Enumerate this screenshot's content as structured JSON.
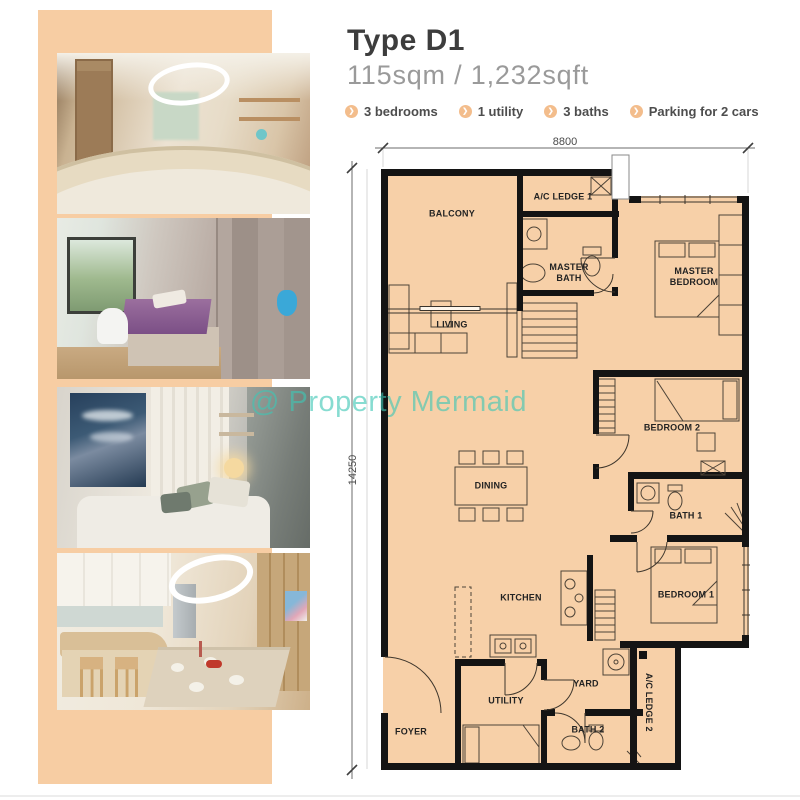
{
  "header": {
    "title": "Type D1",
    "area": "115sqm / 1,232sqft",
    "features": [
      "3 bedrooms",
      "1 utility",
      "3 baths",
      "Parking for 2 cars"
    ]
  },
  "floorplan": {
    "dim_top": "8800",
    "dim_left": "14250",
    "rooms": {
      "balcony": "BALCONY",
      "ac_ledge_1": "A/C LEDGE 1",
      "master_bath": "MASTER BATH",
      "master_bedroom": "MASTER BEDROOM",
      "living": "LIVING",
      "dining": "DINING",
      "bedroom_2": "BEDROOM 2",
      "bath_1": "BATH 1",
      "kitchen": "KITCHEN",
      "bedroom_1": "BEDROOM 1",
      "yard": "YARD",
      "utility": "UTILITY",
      "bath_2": "BATH 2",
      "foyer": "FOYER",
      "ac_ledge_2": "A/C LEDGE 2"
    }
  },
  "watermark": "@ Property Mermaid",
  "colors": {
    "strip_peach": "#f7cda3",
    "floor_fill": "#f7d0a8",
    "wall_black": "#141414",
    "watermark_teal": "#3ec6b4",
    "bullet_orange": "#f3bd8c",
    "title_gray": "#3d3d3d",
    "subtitle_gray": "#9a9a9a"
  }
}
